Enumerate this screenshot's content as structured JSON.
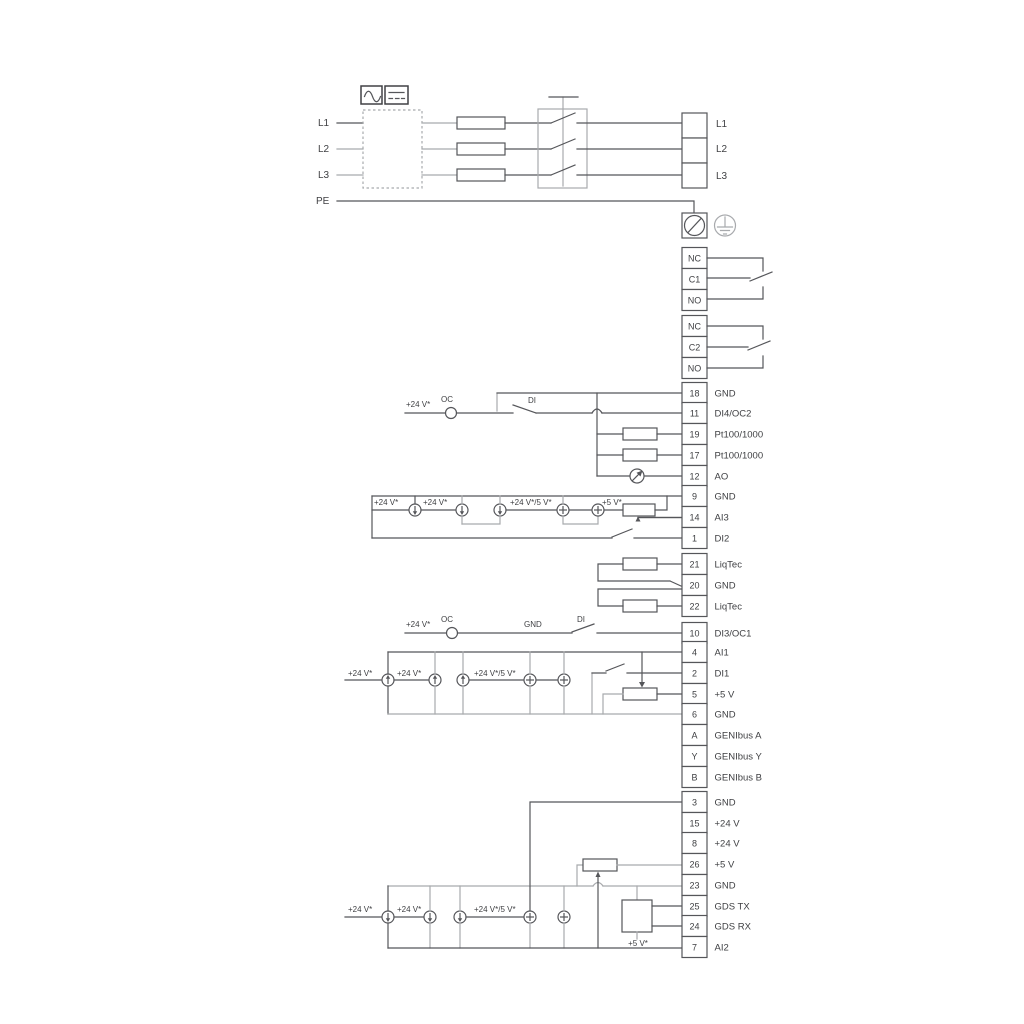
{
  "diagram": {
    "type": "wiring-diagram",
    "colors": {
      "line_dark": "#55565a",
      "line_gray": "#a8aaad",
      "text": "#3e3f42"
    },
    "power_in": {
      "l1": "L1",
      "l2": "L2",
      "l3": "L3",
      "pe": "PE"
    },
    "power_out": {
      "l1": "L1",
      "l2": "L2",
      "l3": "L3"
    },
    "relay1": {
      "nc": "NC",
      "c": "C1",
      "no": "NO"
    },
    "relay2": {
      "nc": "NC",
      "c": "C2",
      "no": "NO"
    },
    "ann": {
      "p24": "+24 V*",
      "p24_5": "+24 V*/5 V*",
      "p5": "+5 V*",
      "oc": "OC",
      "di": "DI",
      "gnd": "GND"
    },
    "terminals": [
      {
        "num": "18",
        "label": "GND"
      },
      {
        "num": "11",
        "label": "DI4/OC2"
      },
      {
        "num": "19",
        "label": "Pt100/1000"
      },
      {
        "num": "17",
        "label": "Pt100/1000"
      },
      {
        "num": "12",
        "label": "AO"
      },
      {
        "num": "9",
        "label": "GND"
      },
      {
        "num": "14",
        "label": "AI3"
      },
      {
        "num": "1",
        "label": "DI2"
      },
      {
        "num": "21",
        "label": "LiqTec"
      },
      {
        "num": "20",
        "label": "GND"
      },
      {
        "num": "22",
        "label": "LiqTec"
      },
      {
        "num": "10",
        "label": "DI3/OC1"
      },
      {
        "num": "4",
        "label": "AI1"
      },
      {
        "num": "2",
        "label": "DI1"
      },
      {
        "num": "5",
        "label": "+5 V"
      },
      {
        "num": "6",
        "label": "GND"
      },
      {
        "num": "A",
        "label": "GENIbus A"
      },
      {
        "num": "Y",
        "label": "GENIbus Y"
      },
      {
        "num": "B",
        "label": "GENIbus B"
      },
      {
        "num": "3",
        "label": "GND"
      },
      {
        "num": "15",
        "label": "+24 V"
      },
      {
        "num": "8",
        "label": "+24 V"
      },
      {
        "num": "26",
        "label": "+5 V"
      },
      {
        "num": "23",
        "label": "GND"
      },
      {
        "num": "25",
        "label": "GDS TX"
      },
      {
        "num": "24",
        "label": "GDS RX"
      },
      {
        "num": "7",
        "label": "AI2"
      }
    ]
  }
}
